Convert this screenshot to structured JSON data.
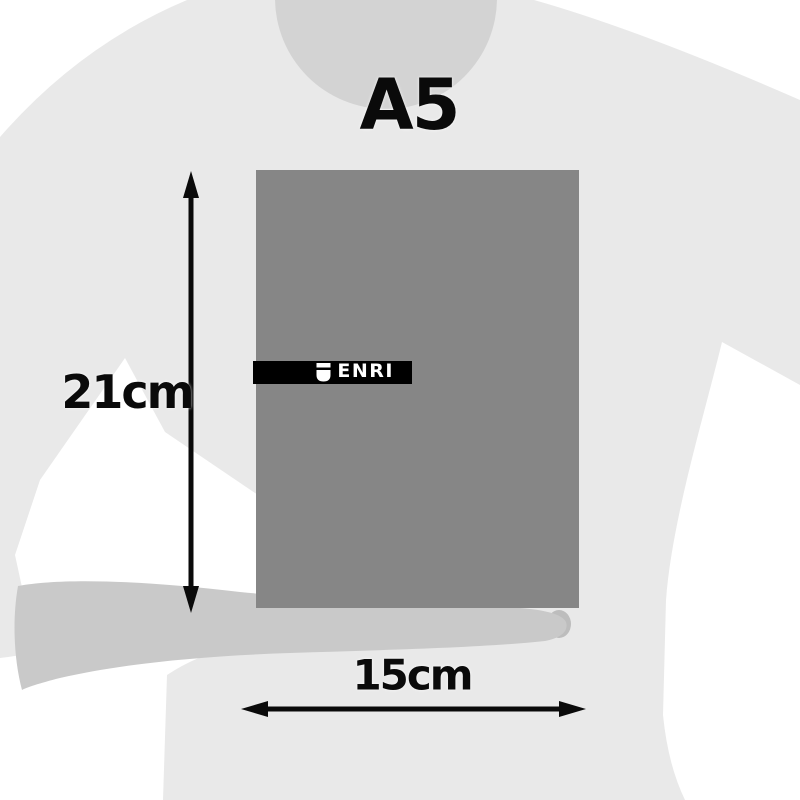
{
  "title": {
    "label": "A5"
  },
  "dimensions": {
    "height": {
      "label": "21cm"
    },
    "width": {
      "label": "15cm"
    }
  },
  "notebook": {
    "brand_label": "ENRI",
    "brand_icon": "shield-badge-icon",
    "cover_color": "#868686",
    "banner_color": "#000000",
    "banner_text_color": "#ffffff"
  },
  "silhouette": {
    "background_color": "#ffffff",
    "torso_color": "#e9e9e9",
    "head_color": "#d3d3d3",
    "forearm_color": "#c9c9c9",
    "thumb_color": "#bdbdbd"
  },
  "annotations": {
    "arrow_color": "#0a0a0a"
  }
}
